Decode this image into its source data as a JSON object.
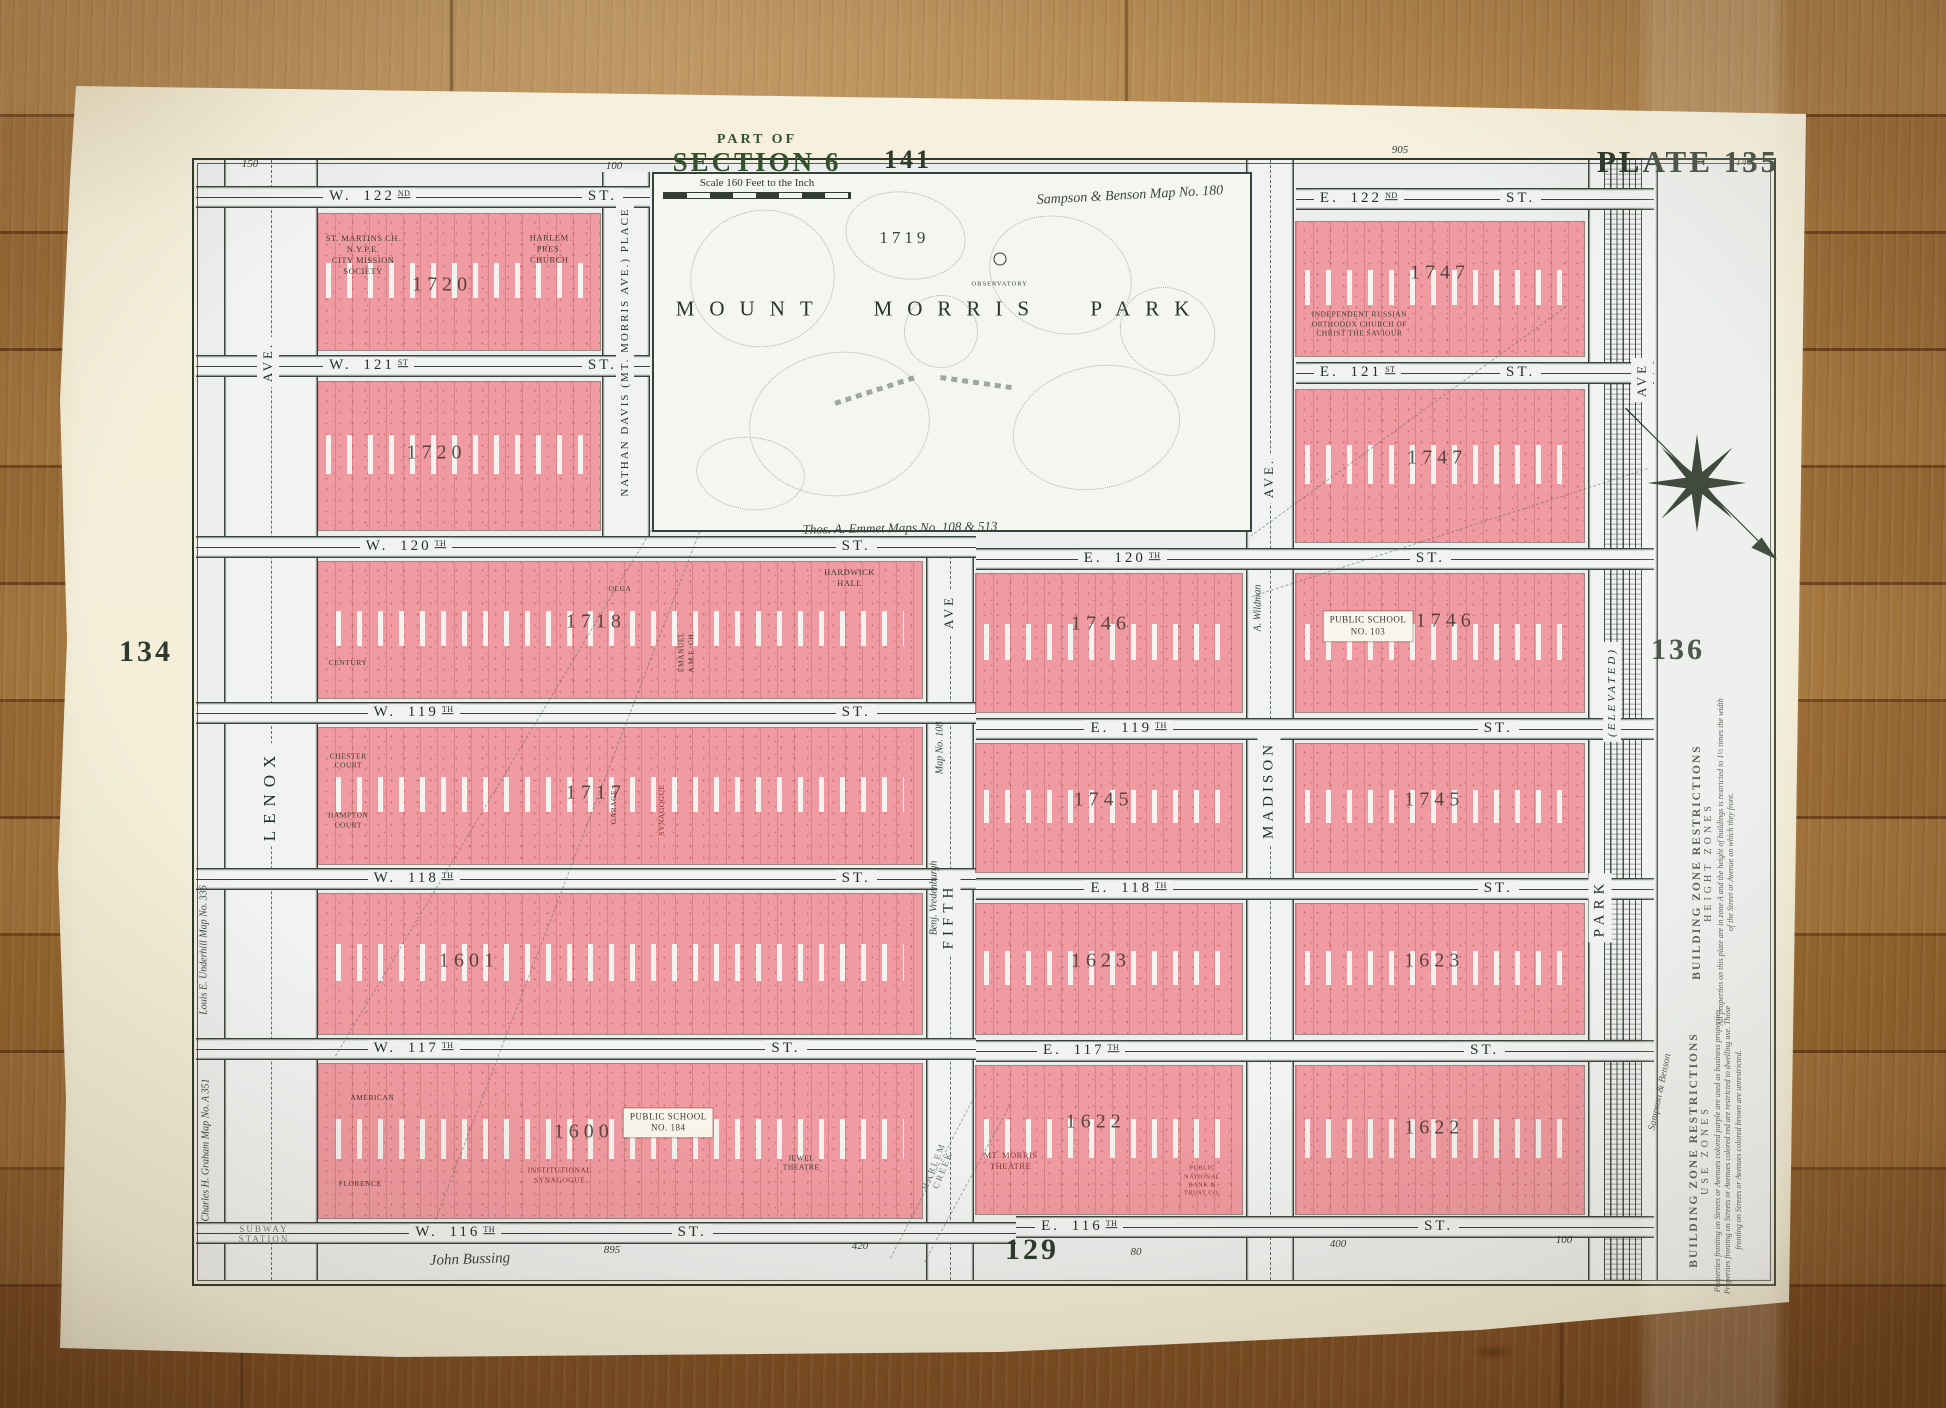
{
  "map": {
    "title": {
      "part_of": "PART OF",
      "section": "SECTION 6",
      "scale_label": "Scale 160 Feet to the Inch"
    },
    "plate_numbers": [
      {
        "t": "PLATE 135",
        "x": 1688,
        "y": 162,
        "s": 31
      },
      {
        "t": "141",
        "x": 908,
        "y": 160,
        "s": 26
      },
      {
        "t": "134",
        "x": 146,
        "y": 652,
        "s": 30
      },
      {
        "t": "136",
        "x": 1678,
        "y": 650,
        "s": 30
      },
      {
        "t": "129",
        "x": 1032,
        "y": 1250,
        "s": 30
      }
    ],
    "park": {
      "name": "MOUNT MORRIS PARK",
      "block_number": "1719",
      "observatory_label": "OBSERVATORY"
    },
    "street_suffix": "ST.",
    "streets": [
      {
        "n": "W. 122",
        "o": "ND",
        "x": 196,
        "y": 186,
        "w": 454,
        "lx": 28,
        "sx": 85
      },
      {
        "n": "E. 122",
        "o": "ND",
        "x": 1296,
        "y": 188,
        "w": 358,
        "lx": 5,
        "sx": 57
      },
      {
        "n": "W. 121",
        "o": "ST",
        "x": 196,
        "y": 355,
        "w": 454,
        "lx": 28,
        "sx": 85
      },
      {
        "n": "E. 121",
        "o": "ST",
        "x": 1296,
        "y": 362,
        "w": 358,
        "lx": 5,
        "sx": 57
      },
      {
        "n": "W. 120",
        "o": "TH",
        "x": 196,
        "y": 536,
        "w": 780,
        "lx": 21,
        "sx": 82
      },
      {
        "n": "E. 120",
        "o": "TH",
        "x": 976,
        "y": 548,
        "w": 678,
        "lx": 15,
        "sx": 64
      },
      {
        "n": "W. 119",
        "o": "TH",
        "x": 196,
        "y": 702,
        "w": 780,
        "lx": 22,
        "sx": 82
      },
      {
        "n": "E. 119",
        "o": "TH",
        "x": 976,
        "y": 718,
        "w": 678,
        "lx": 16,
        "sx": 74
      },
      {
        "n": "W. 118",
        "o": "TH",
        "x": 196,
        "y": 868,
        "w": 780,
        "lx": 22,
        "sx": 82
      },
      {
        "n": "E. 118",
        "o": "TH",
        "x": 976,
        "y": 878,
        "w": 678,
        "lx": 16,
        "sx": 74
      },
      {
        "n": "W. 117",
        "o": "TH",
        "x": 196,
        "y": 1038,
        "w": 780,
        "lx": 22,
        "sx": 73
      },
      {
        "n": "E. 117",
        "o": "TH",
        "x": 976,
        "y": 1040,
        "w": 678,
        "lx": 9,
        "sx": 72
      },
      {
        "n": "W. 116",
        "o": "TH",
        "x": 196,
        "y": 1222,
        "w": 820,
        "lx": 26,
        "sx": 58
      },
      {
        "n": "E. 116",
        "o": "TH",
        "x": 1016,
        "y": 1216,
        "w": 638,
        "lx": 3,
        "sx": 63
      }
    ],
    "avenues": [
      {
        "id": "lenox-ave",
        "x": 224,
        "w": 92,
        "y": 160,
        "h": 1120,
        "dashes": true,
        "labels": [
          {
            "t": "AVE.",
            "cx": 268,
            "cy": 362,
            "s": 13
          },
          {
            "t": "LENOX",
            "cx": 270,
            "cy": 795,
            "s": 17,
            "ls": 7
          }
        ]
      },
      {
        "id": "nathan-davis-place",
        "x": 602,
        "w": 46,
        "y": 172,
        "h": 364,
        "dashes": false,
        "labels": [
          {
            "t": "NATHAN DAVIS (MT. MORRIS AVE.) PLACE",
            "cx": 625,
            "cy": 352,
            "s": 11,
            "ls": 2
          }
        ]
      },
      {
        "id": "fifth-ave",
        "x": 926,
        "w": 46,
        "y": 546,
        "h": 734,
        "dashes": true,
        "labels": [
          {
            "t": "AVE",
            "cx": 949,
            "cy": 612,
            "s": 13
          },
          {
            "t": "FIFTH",
            "cx": 949,
            "cy": 916,
            "s": 15,
            "ls": 5
          }
        ]
      },
      {
        "id": "madison-ave",
        "x": 1246,
        "w": 46,
        "y": 160,
        "h": 1120,
        "dashes": true,
        "labels": [
          {
            "t": "AVE.",
            "cx": 1269,
            "cy": 478,
            "s": 13
          },
          {
            "t": "MADISON",
            "cx": 1269,
            "cy": 790,
            "s": 15,
            "ls": 4
          }
        ]
      },
      {
        "id": "park-ave",
        "x": 1588,
        "w": 68,
        "y": 160,
        "h": 1120,
        "rail": true,
        "labels": [
          {
            "t": "AVE",
            "cx": 1642,
            "cy": 380,
            "s": 13
          },
          {
            "t": "(ELEVATED)",
            "cx": 1612,
            "cy": 692,
            "s": 11,
            "it": true
          },
          {
            "t": "PARK",
            "cx": 1600,
            "cy": 908,
            "s": 15,
            "ls": 5
          }
        ]
      }
    ],
    "blocks": [
      {
        "num": "1720",
        "x": 318,
        "y": 214,
        "w": 282,
        "h": 136,
        "nx": 44,
        "ny": 52,
        "lm": [
          {
            "t": "ST. MARTINS CH.\nN.Y.P.E.\nCITY MISSION\nSOCIETY",
            "x": 16,
            "y": 30
          },
          {
            "t": "HARLEM\nPRES. CHURCH",
            "x": 82,
            "y": 26
          }
        ]
      },
      {
        "num": "1747",
        "x": 1296,
        "y": 222,
        "w": 288,
        "h": 134,
        "nx": 50,
        "ny": 38,
        "lm": [
          {
            "t": "INDEPENDENT RUSSIAN\nORTHODOX CHURCH OF\nCHRIST THE SAVIOUR",
            "x": 22,
            "y": 76,
            "cls": "sm"
          }
        ]
      },
      {
        "num": "1720",
        "x": 318,
        "y": 382,
        "w": 282,
        "h": 148,
        "nx": 42,
        "ny": 48,
        "lm": []
      },
      {
        "num": "1747",
        "x": 1296,
        "y": 390,
        "w": 288,
        "h": 152,
        "nx": 49,
        "ny": 45,
        "lm": []
      },
      {
        "num": "1718",
        "x": 318,
        "y": 562,
        "w": 604,
        "h": 136,
        "nx": 46,
        "ny": 44,
        "lm": [
          {
            "t": "HARDWICK HALL",
            "x": 88,
            "y": 12
          },
          {
            "t": "OLGA",
            "x": 50,
            "y": 20,
            "cls": "sm"
          },
          {
            "t": "CENTURY",
            "x": 5,
            "y": 74,
            "cls": "sm"
          },
          {
            "t": "EMANUEL\nA.M.E. CH.",
            "x": 61,
            "y": 66,
            "cls": "rot sm"
          }
        ]
      },
      {
        "num": "1746",
        "x": 976,
        "y": 574,
        "w": 266,
        "h": 138,
        "nx": 47,
        "ny": 36,
        "lm": []
      },
      {
        "num": "1746",
        "x": 1296,
        "y": 574,
        "w": 288,
        "h": 138,
        "nx": 52,
        "ny": 34,
        "lm": [
          {
            "t": "PUBLIC SCHOOL\nNO. 103",
            "x": 25,
            "y": 38,
            "cls": "panel"
          }
        ]
      },
      {
        "num": "1717",
        "x": 318,
        "y": 728,
        "w": 604,
        "h": 136,
        "nx": 46,
        "ny": 48,
        "lm": [
          {
            "t": "CHESTER\nCOURT",
            "x": 5,
            "y": 24,
            "cls": "sm"
          },
          {
            "t": "HAMPTON\nCOURT",
            "x": 5,
            "y": 68,
            "cls": "sm"
          },
          {
            "t": "GARAGE",
            "x": 49,
            "y": 58,
            "cls": "rot sm"
          },
          {
            "t": "SYNAGOGUE",
            "x": 57,
            "y": 60,
            "cls": "rot sm red"
          }
        ]
      },
      {
        "num": "1745",
        "x": 976,
        "y": 744,
        "w": 266,
        "h": 128,
        "nx": 48,
        "ny": 44,
        "lm": []
      },
      {
        "num": "1745",
        "x": 1296,
        "y": 744,
        "w": 288,
        "h": 128,
        "nx": 48,
        "ny": 44,
        "lm": []
      },
      {
        "num": "1601",
        "x": 318,
        "y": 894,
        "w": 604,
        "h": 140,
        "nx": 25,
        "ny": 48,
        "lm": []
      },
      {
        "num": "1623",
        "x": 976,
        "y": 904,
        "w": 266,
        "h": 130,
        "nx": 47,
        "ny": 44,
        "lm": []
      },
      {
        "num": "1623",
        "x": 1296,
        "y": 904,
        "w": 288,
        "h": 130,
        "nx": 48,
        "ny": 44,
        "lm": []
      },
      {
        "num": "1600",
        "x": 318,
        "y": 1064,
        "w": 604,
        "h": 154,
        "nx": 44,
        "ny": 44,
        "lm": [
          {
            "t": "AMERICAN",
            "x": 9,
            "y": 22,
            "cls": "sm"
          },
          {
            "t": "FLORENCE",
            "x": 7,
            "y": 78,
            "cls": "sm"
          },
          {
            "t": "PUBLIC SCHOOL\nNO. 184",
            "x": 58,
            "y": 38,
            "cls": "panel"
          },
          {
            "t": "INSTITUTIONAL\nSYNAGOGUE",
            "x": 40,
            "y": 72,
            "cls": "sm red"
          },
          {
            "t": "JEWEL\nTHEATRE",
            "x": 80,
            "y": 64,
            "cls": "sm"
          }
        ]
      },
      {
        "num": "1622",
        "x": 976,
        "y": 1066,
        "w": 266,
        "h": 148,
        "nx": 45,
        "ny": 38,
        "lm": [
          {
            "t": "MT. MORRIS\nTHEATRE",
            "x": 13,
            "y": 64,
            "cls": "red"
          },
          {
            "t": "PUBLIC NATIONAL\nBANK & TRUST CO.",
            "x": 85,
            "y": 78,
            "cls": "tiny red"
          }
        ]
      },
      {
        "num": "1622",
        "x": 1296,
        "y": 1066,
        "w": 288,
        "h": 148,
        "nx": 48,
        "ny": 42,
        "lm": []
      }
    ],
    "annotations": [
      {
        "t": "Sampson & Benson Map No. 180",
        "x": 1130,
        "y": 196,
        "s": 14,
        "rot": -3
      },
      {
        "t": "Thos. A. Emmet   Maps No. 108 & 513",
        "x": 900,
        "y": 528,
        "s": 13,
        "rot": -1
      },
      {
        "t": "John Bussing",
        "x": 470,
        "y": 1260,
        "s": 15,
        "rot": -2
      },
      {
        "t": "Louis E. Underhill Map No. 336",
        "x": 204,
        "y": 950,
        "s": 10,
        "rot": -90
      },
      {
        "t": "Charles H. Graham Map No. A 351",
        "x": 206,
        "y": 1150,
        "s": 10,
        "rot": -90
      },
      {
        "t": "Benj. Vredenburgh",
        "x": 934,
        "y": 898,
        "s": 10,
        "rot": -90
      },
      {
        "t": "Map No. 108",
        "x": 940,
        "y": 748,
        "s": 10,
        "rot": -90
      },
      {
        "t": "A. Wildman",
        "x": 1258,
        "y": 608,
        "s": 10,
        "rot": -90
      },
      {
        "t": "Sampson & Benson",
        "x": 1660,
        "y": 1092,
        "s": 10,
        "rot": -78
      }
    ],
    "margin_numbers": [
      {
        "t": "150",
        "x": 250,
        "y": 164
      },
      {
        "t": "100",
        "x": 614,
        "y": 166
      },
      {
        "t": "905",
        "x": 1400,
        "y": 150
      },
      {
        "t": "140",
        "x": 1744,
        "y": 162
      },
      {
        "t": "895",
        "x": 612,
        "y": 1250
      },
      {
        "t": "420",
        "x": 860,
        "y": 1246
      },
      {
        "t": "80",
        "x": 1136,
        "y": 1252
      },
      {
        "t": "400",
        "x": 1338,
        "y": 1244
      },
      {
        "t": "100",
        "x": 1564,
        "y": 1240
      }
    ],
    "zone_restrictions": {
      "height": {
        "heading": "BUILDING ZONE RESTRICTIONS",
        "subheading": "HEIGHT ZONES",
        "body": "All properties on this plate are in zone A and the height of buildings is restricted to 1½ times the width of the Street or Avenue on which they front."
      },
      "use": {
        "heading": "BUILDING ZONE RESTRICTIONS",
        "subheading": "USE ZONES",
        "body": "Properties fronting on Streets or Avenues colored purple are used as business properties. Properties fronting on Streets or Avenues colored red are restricted to dwelling use. Those fronting on Streets or Avenues colored brown are unrestricted."
      }
    },
    "extras": {
      "subway_station": "SUBWAY\nSTATION",
      "harlem_creek": "HARLEM\nCREEK"
    },
    "park_shapes": [
      {
        "x": 6,
        "y": 10,
        "w": 24,
        "h": 38,
        "rot": -15
      },
      {
        "x": 32,
        "y": 5,
        "w": 20,
        "h": 24,
        "rot": 10
      },
      {
        "x": 16,
        "y": 50,
        "w": 30,
        "h": 40,
        "rot": -6
      },
      {
        "x": 56,
        "y": 12,
        "w": 24,
        "h": 32,
        "rot": 18
      },
      {
        "x": 60,
        "y": 54,
        "w": 28,
        "h": 34,
        "rot": -12
      },
      {
        "x": 42,
        "y": 34,
        "w": 12,
        "h": 20,
        "rot": 0
      },
      {
        "x": 78,
        "y": 32,
        "w": 16,
        "h": 24,
        "rot": 24
      },
      {
        "x": 7,
        "y": 74,
        "w": 18,
        "h": 20,
        "rot": 6
      }
    ],
    "park_dashes": [
      {
        "x": 30,
        "y": 60,
        "w": 14,
        "rot": -18
      },
      {
        "x": 48,
        "y": 58,
        "w": 12,
        "rot": 8
      }
    ],
    "dashed_lines": [
      {
        "x1": 652,
        "y1": 530,
        "x2": 336,
        "y2": 1056
      },
      {
        "x1": 700,
        "y1": 532,
        "x2": 436,
        "y2": 1220
      },
      {
        "x1": 1250,
        "y1": 536,
        "x2": 1566,
        "y2": 306
      },
      {
        "x1": 1252,
        "y1": 596,
        "x2": 1648,
        "y2": 468
      },
      {
        "x1": 890,
        "y1": 1258,
        "x2": 976,
        "y2": 1092
      },
      {
        "x1": 924,
        "y1": 1262,
        "x2": 1010,
        "y2": 1104
      }
    ],
    "colors": {
      "block_pink": "#f09ba1",
      "line_dark": "#333c33",
      "title_green": "#33502f",
      "paper": "#f3eed8"
    }
  }
}
